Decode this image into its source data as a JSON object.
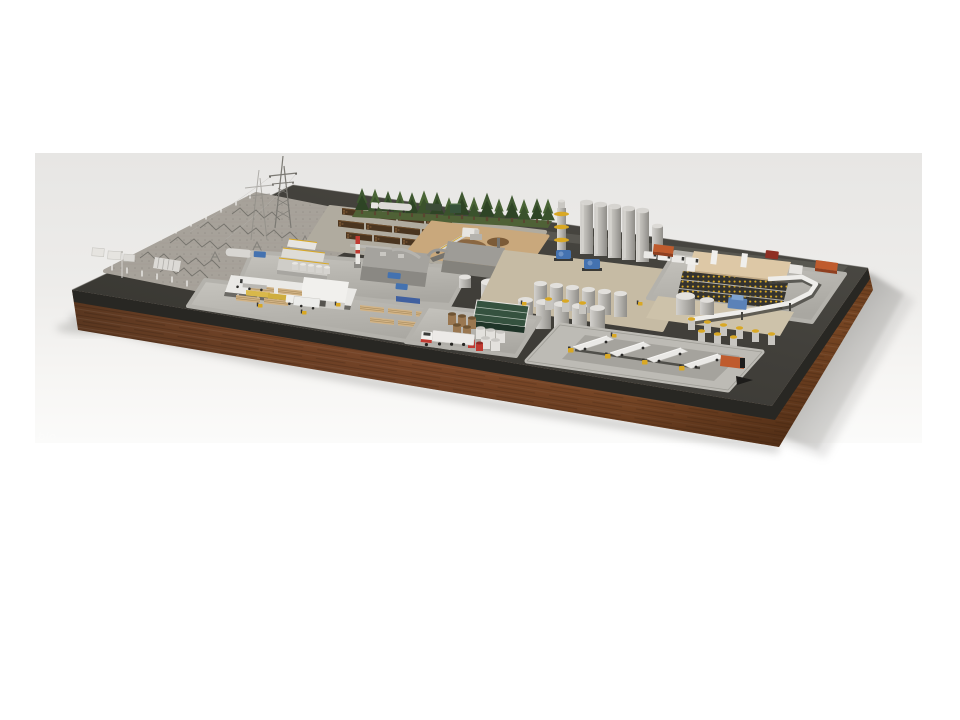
{
  "scene": {
    "description": "Photoreal 3D miniature model of a wood-processing bio-energy industrial plant standing on a dark display board with a walnut wood base, shot on a pale studio backdrop; soft shadow cast to the lower right",
    "watermark_text": "bio"
  },
  "palette": {
    "page_bg": "#ffffff",
    "backdrop_top": "#e7e6e4",
    "backdrop_bottom": "#fbfbfa",
    "board_top": "#413f3a",
    "board_side": "#282723",
    "wood_mid": "#8a5130",
    "wood_dark": "#59361f",
    "pad_gray": "#b4b2ac",
    "sand_tan": "#c9a87c",
    "tree_green": "#3f5831",
    "tree_dark": "#2e4425",
    "log_brown": "#4a3520",
    "lumber_tan": "#d2b386",
    "silo_gray": "#b7b5b0",
    "accent_yellow": "#d9a824",
    "accent_orange": "#bf5b2d",
    "accent_blue": "#4472b0",
    "accent_red": "#c03a31",
    "green_building": "#35523f",
    "truck_white": "#eceae7",
    "shadow_gray": "#a3a2a0"
  },
  "counts": {
    "trees": 16,
    "silos": 5,
    "dock_trailers": 4,
    "shipping_containers": 3,
    "log_stacks": 11
  },
  "regions": {
    "substation": "electrical substation yard",
    "transmission_tower": "high-voltage lattice tower",
    "tree_line": "row of conifer trees",
    "log_yard": "stacked timber logs",
    "chip_pit": "wood-chip pit with grab crane",
    "boiler_plant": "boiler house with striped chimney",
    "lumber_mill": "lumber mill and drying sheds",
    "silos": "tall storage silos",
    "tank_farm": "process tank farm",
    "warehouse": "warehouse with pallet racking",
    "pipe_bridge": "overhead pipe bridge",
    "containers": "shipping containers",
    "roll_storage": "roll storage and green plant building",
    "semi_truck": "white semi-trailer truck",
    "loading_dock": "truck loading dock",
    "wooden_base": "walnut wood base"
  }
}
